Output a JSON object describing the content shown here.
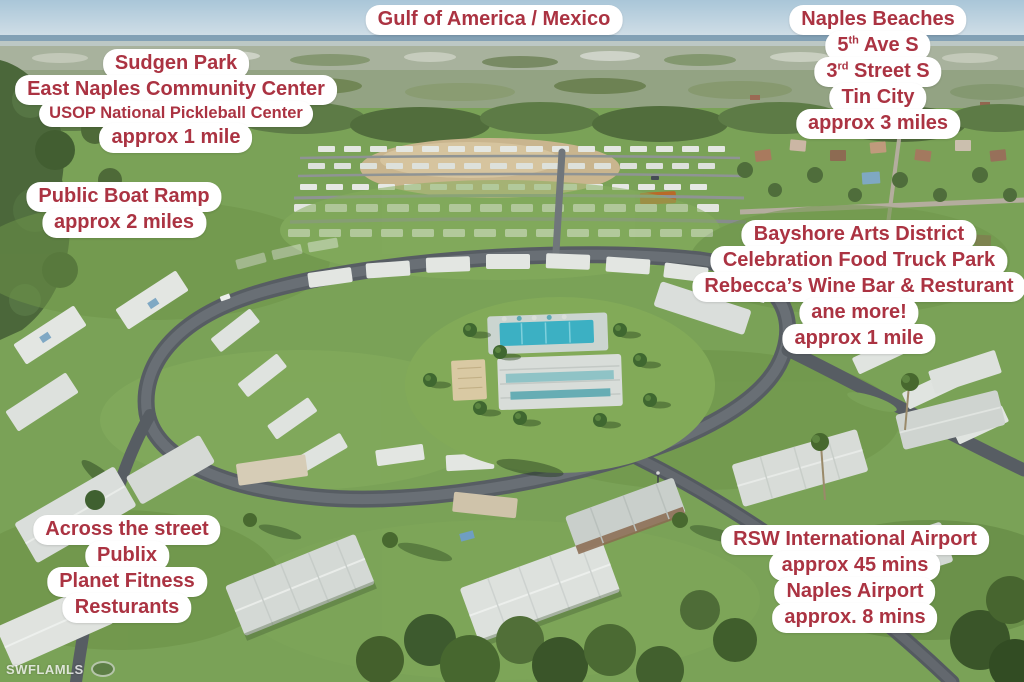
{
  "labels": {
    "gulf": {
      "lines": [
        "Gulf of America / Mexico"
      ]
    },
    "sudgen_park": {
      "lines": [
        "Sudgen Park",
        "East Naples Community Center",
        "USOP National Pickleball Center",
        "approx 1 mile"
      ]
    },
    "naples_beaches": {
      "title": "Naples Beaches",
      "fifth_ave": {
        "pre": "5",
        "sup": "th",
        "post": " Ave S"
      },
      "third_street": {
        "pre": "3",
        "sup": "rd",
        "post": " Street S"
      },
      "tin_city": "Tin City",
      "distance": "approx 3 miles"
    },
    "public_boat_ramp": {
      "lines": [
        "Public Boat Ramp",
        "approx 2 miles"
      ]
    },
    "bayshore": {
      "lines": [
        "Bayshore Arts District",
        "Celebration Food Truck Park",
        "Rebecca’s Wine Bar & Resturant",
        "ane more!",
        "approx 1 mile"
      ]
    },
    "across_the_street": {
      "lines": [
        "Across the street",
        "Publix",
        "Planet Fitness",
        "Resturants"
      ]
    },
    "airports": {
      "lines": [
        "RSW International Airport",
        "approx 45 mins",
        "Naples Airport",
        "approx. 8 mins"
      ]
    }
  },
  "watermark": "SWFLAMLS",
  "colors": {
    "label_text": "#ab3342",
    "label_bg": "#ffffff",
    "pool_water": "#3cb0c3",
    "road": "#575d63",
    "grass": "#7aa257",
    "sea": "#7495ab",
    "sky": "#a9c6d8"
  }
}
